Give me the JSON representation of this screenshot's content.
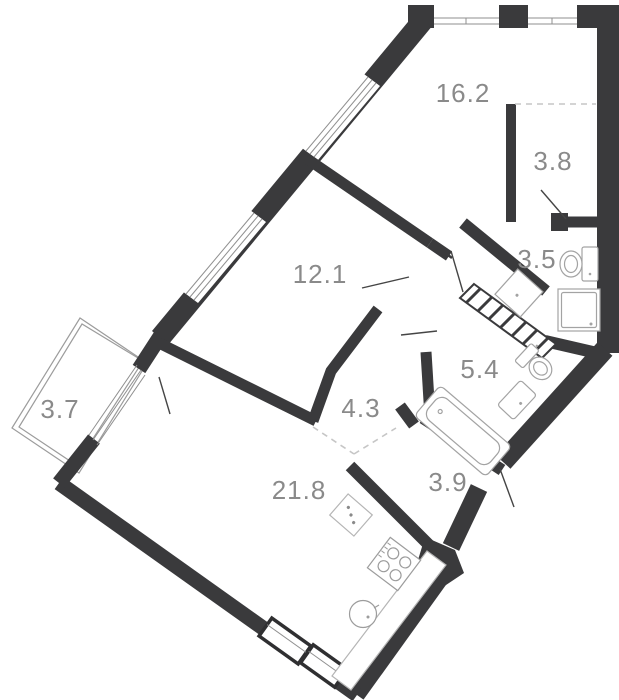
{
  "plan": {
    "title": "apartment-floor-plan",
    "rooms": [
      {
        "id": "living-room",
        "area": "16.2"
      },
      {
        "id": "hall-wardrobe",
        "area": "3.8"
      },
      {
        "id": "shower-room",
        "area": "3.5"
      },
      {
        "id": "bedroom",
        "area": "12.1"
      },
      {
        "id": "bathroom",
        "area": "5.4"
      },
      {
        "id": "corridor",
        "area": "4.3"
      },
      {
        "id": "balcony",
        "area": "3.7"
      },
      {
        "id": "entry-hall",
        "area": "3.9"
      },
      {
        "id": "kitchen-living",
        "area": "21.8"
      }
    ],
    "colors": {
      "wall": "#3a3a3c",
      "label": "#8a8a8a",
      "fixture_line": "#a3a3a3",
      "counter_line": "#b5b5b5",
      "window_line": "#8f8f8f",
      "dash_line": "#c6c6c6",
      "door_swing": "#454545",
      "background": "#ffffff"
    }
  }
}
